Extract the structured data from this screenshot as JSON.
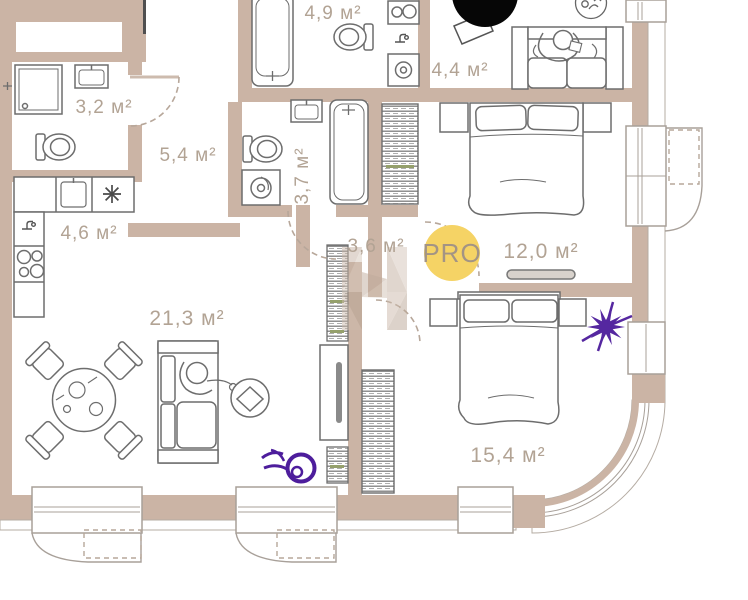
{
  "plan": {
    "type": "apartment-floor-plan",
    "badge": {
      "label": "PRO"
    },
    "rooms": [
      {
        "id": "bathroom-small",
        "area_label": "3,2 м²"
      },
      {
        "id": "hallway",
        "area_label": "5,4 м²"
      },
      {
        "id": "kitchen",
        "area_label": "4,6 м²"
      },
      {
        "id": "bathroom-top",
        "area_label": "4,9 м²"
      },
      {
        "id": "study",
        "area_label": "4,4 м²"
      },
      {
        "id": "bathroom-mid",
        "area_label": "3,7 м²"
      },
      {
        "id": "corridor",
        "area_label": "3,6 м²"
      },
      {
        "id": "bedroom-1",
        "area_label": "12,0 м²"
      },
      {
        "id": "living-room",
        "area_label": "21,3 м²"
      },
      {
        "id": "bedroom-2",
        "area_label": "15,4 м²"
      }
    ],
    "colors": {
      "wall": "#cbb4a5",
      "label_text": "#b2a394",
      "badge_bg": "#f5d365",
      "badge_text": "#a39484",
      "accent_purple": "#5527a0",
      "furniture_line": "#6d6d6d"
    },
    "icons": [
      "pro-badge",
      "covered-logo-circle",
      "plant-icon",
      "flower-decor-purple",
      "star-decor-purple",
      "watermark-letter-n"
    ]
  }
}
